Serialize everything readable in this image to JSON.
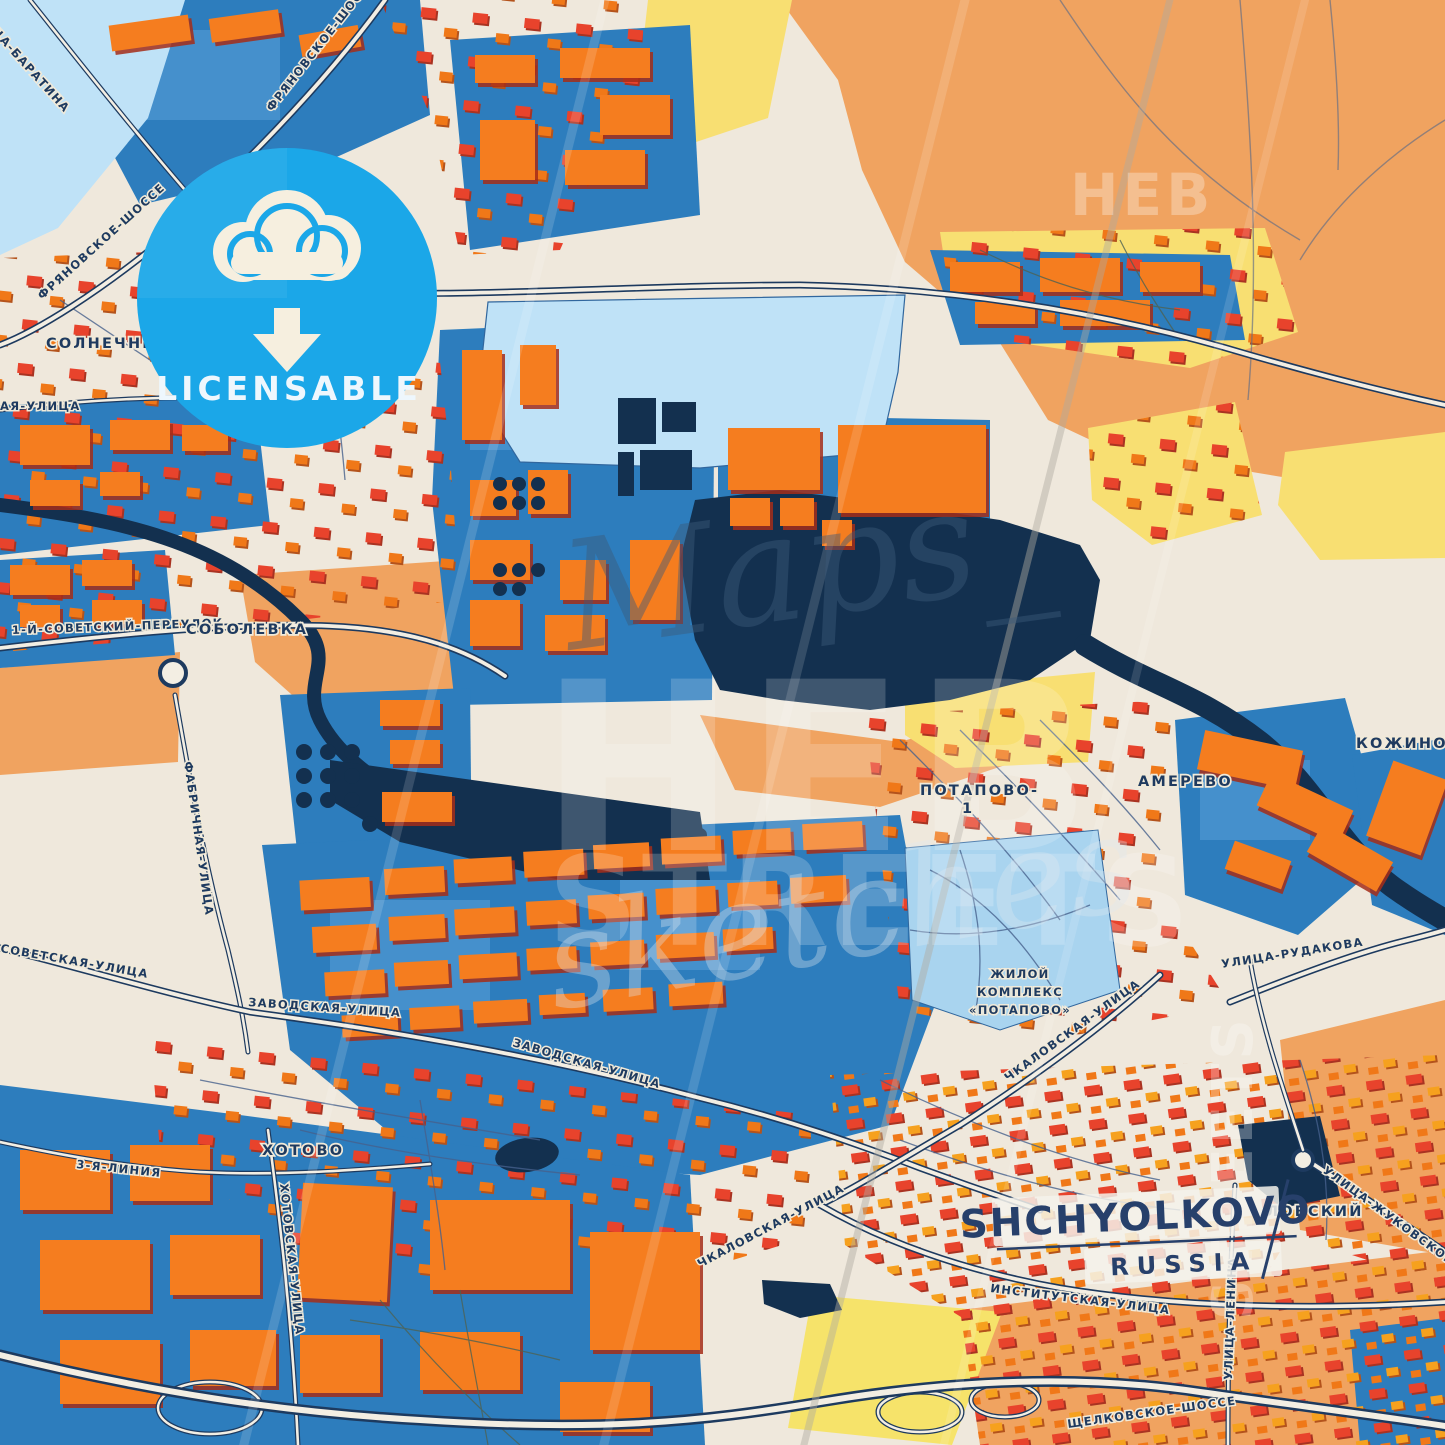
{
  "poster": {
    "badge": {
      "label": "LICENSABLE",
      "icon": "cloud-download-icon"
    },
    "title": {
      "city": "SHCHYOLKOVO",
      "country": "RUSSIA"
    },
    "watermark": {
      "script_word": "Maps_",
      "brand_word": "HEB",
      "streets_word": "STREETS",
      "sketch_word": "sketches"
    }
  },
  "places": {
    "solnechny": "СОЛНЕЧНЫЙ",
    "sobolevka": "СОБОЛЕВКА",
    "potapovo_line1": "ПОТАПОВО-",
    "potapovo_line2": "1",
    "amerevo": "АМЕРЕВО",
    "kozhino": "КОЖИНО",
    "khotovo": "ХОТОВО",
    "complex_line1": "ЖИЛОЙ",
    "complex_line2": "КОМПЛЕКС",
    "complex_line3": "«ПОТАПОВО»",
    "lovsky": "ЛОВСКИЙ"
  },
  "streets": {
    "fryanovskoe": "ФРЯНОВСКОЕ-ШОССЕ",
    "baratina": "УЛИЦА-БАРАТИНА",
    "aya": "АЯ-УЛИЦА",
    "sovetsky_per": "1-Й-СОВЕТСКИЙ-ПЕРЕУЛОК",
    "sovetskaya": "СОВЕТСКАЯ-УЛИЦА",
    "fabrichnaya": "ФАБРИЧНАЯ-УЛИЦА",
    "zavodskaya": "ЗАВОДСКАЯ-УЛИЦА",
    "liniya3": "3-Я-ЛИНИЯ",
    "khotovskaya": "ХОТОВСКАЯ-УЛИЦА",
    "chkalovskaya": "ЧКАЛОВСКАЯ-УЛИЦА",
    "institutskaya": "ИНСТИТУТСКАЯ-УЛИЦА",
    "rudakova": "УЛИЦА-РУДАКОВА",
    "lenina": "УЛИЦА-ЛЕНИНА",
    "zhukovskogo": "УЛИЦА-ЖУКОВСКОГО",
    "shchelkovskoe": "ЩЕЛКОВСКОЕ-ШОССЕ"
  },
  "colors": {
    "background": "#efe8dc",
    "zone_blue": "#2d7dbd",
    "zone_blue_light": "#5aa0d8",
    "water_dark": "#13304f",
    "water_light": "#bfe2f7",
    "zone_orange": "#f0a360",
    "zone_yellow": "#f8df72",
    "building_orange": "#f57d1f",
    "building_red": "#e8432c",
    "road_casing": "#1d3a5f",
    "road_fill": "#f3eee3",
    "label_navy": "#1e3a5f",
    "badge_blue": "#1ba7e8",
    "badge_cream": "#f6efdf",
    "title_navy": "#27406b"
  }
}
